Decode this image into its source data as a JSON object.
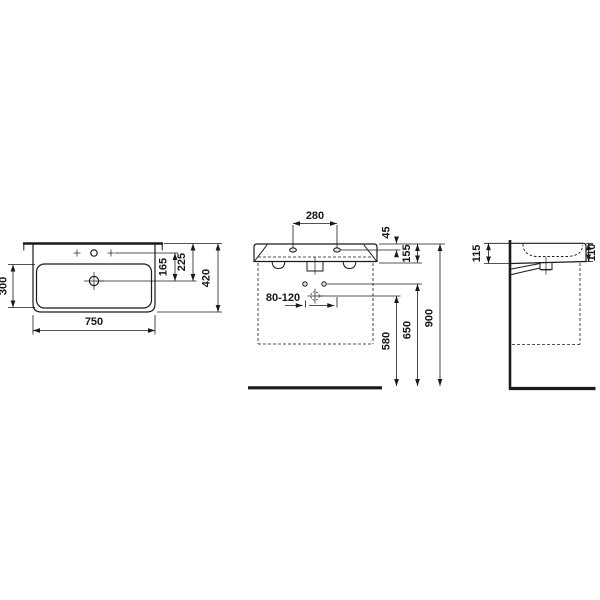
{
  "meta": {
    "drawing_type": "washbasin technical dimension drawing",
    "line_color": "#1a1a1a",
    "background_color": "#ffffff",
    "views": [
      "plan-view",
      "front-view",
      "side-view"
    ]
  },
  "dims": {
    "plan_width": "750",
    "plan_bowl_depth": "300",
    "plan_tap_to_drain": "165",
    "plan_back_to_drain": "225",
    "plan_total_depth": "420",
    "front_hole_spacing": "280",
    "front_rim_to_hole": "45",
    "front_rim_to_apron": "155",
    "front_trap_range": "80-120",
    "front_trap_height": "580",
    "front_fixing_height": "650",
    "front_rim_height": "900",
    "side_back_height": "115",
    "side_front_height": "110"
  }
}
